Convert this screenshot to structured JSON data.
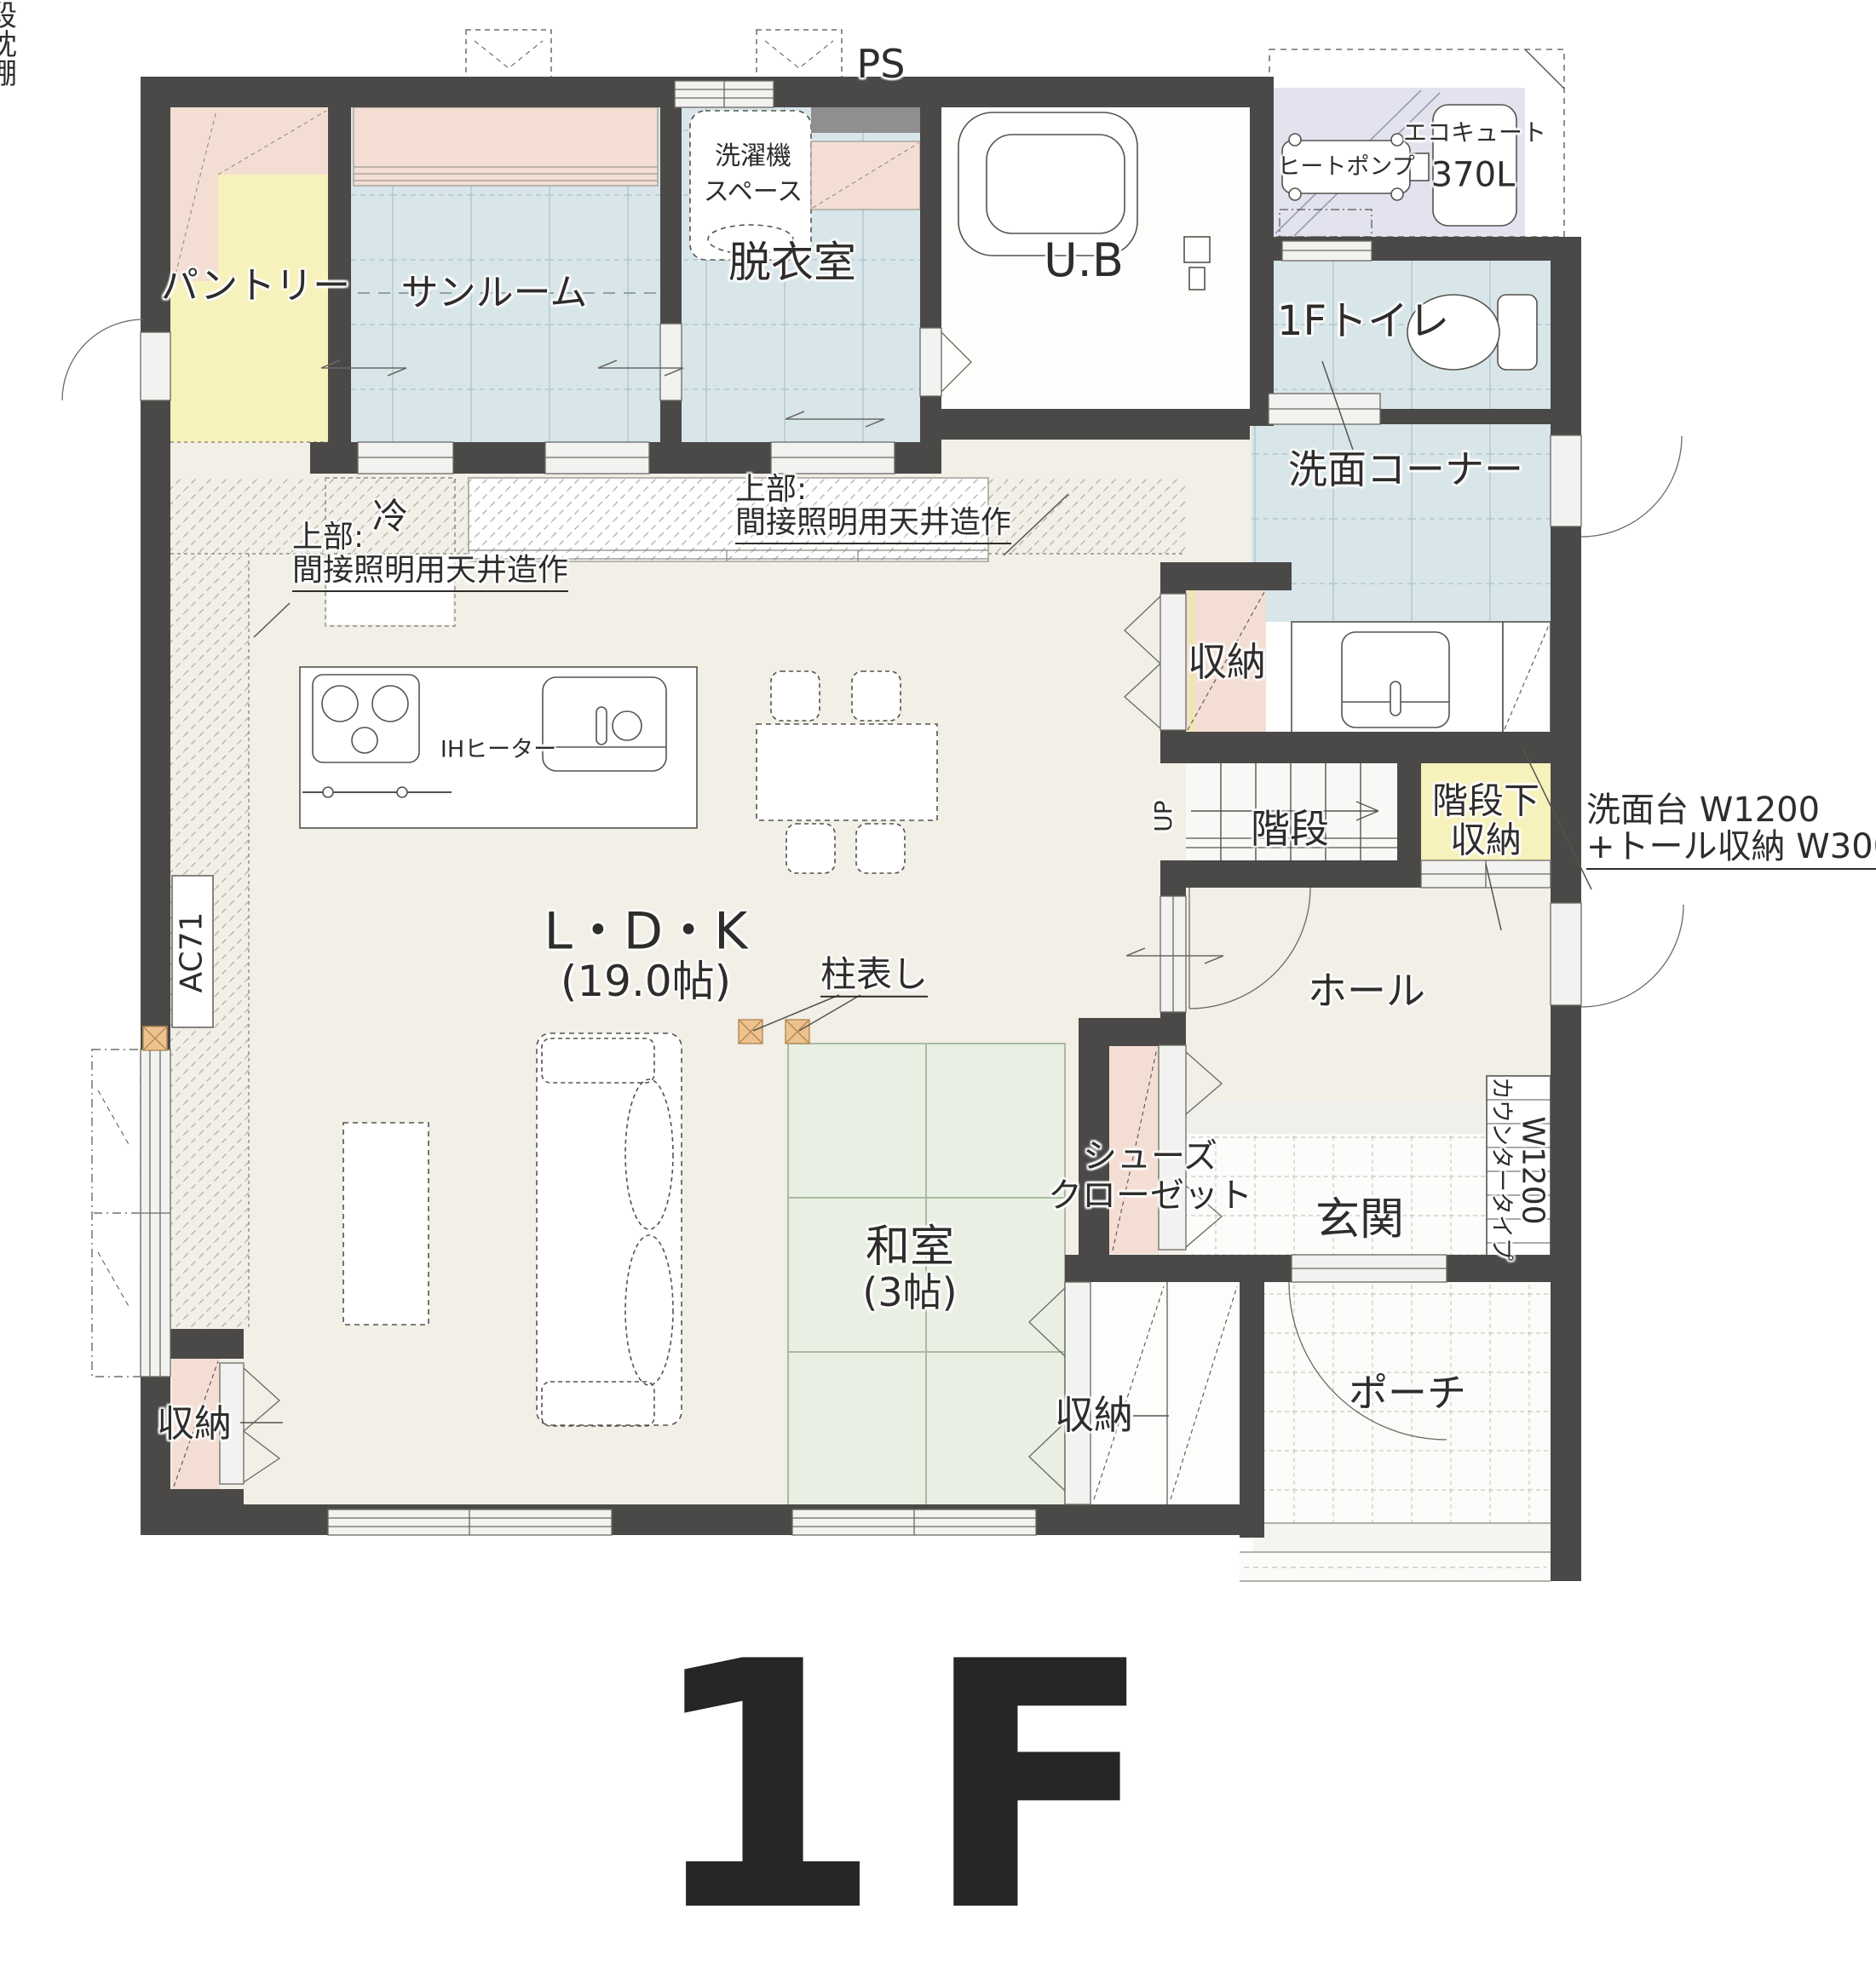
{
  "title": {
    "floor": "1F"
  },
  "colors": {
    "wall": "#4a4947",
    "floor_beige": "#f2efe7",
    "tile_blue": "#d8e6ea",
    "tatami_green": "#e9f0e3",
    "accent_yellow": "#f7f1bb",
    "accent_pink": "#f4ded3",
    "pad_lavender": "#e2e3ef",
    "pillar_orange": "#eec28e",
    "ps_gray": "#8f8f8f"
  },
  "rooms": {
    "pantry": {
      "label": "パントリー"
    },
    "sunroom": {
      "label": "サンルーム"
    },
    "laundry": {
      "line1": "洗濯機",
      "line2": "スペース"
    },
    "ps": {
      "label": "PS"
    },
    "dressing": {
      "label": "脱衣室"
    },
    "bath": {
      "label": "U.B"
    },
    "toilet": {
      "label": "1Fトイレ"
    },
    "wash_corner": {
      "label": "洗面コーナー"
    },
    "storage_wash": {
      "label": "収納"
    },
    "stairs": {
      "label": "階段",
      "up": "UP"
    },
    "under_stairs": {
      "line1": "階段下",
      "line2": "収納"
    },
    "hall": {
      "label": "ホール"
    },
    "entrance": {
      "label": "玄関"
    },
    "shoe_closet": {
      "line1": "シューズ",
      "line2": "クローゼット"
    },
    "ldk": {
      "label": "L・D・K",
      "size": "(19.0帖)"
    },
    "tatami_room": {
      "label": "和室",
      "size": "(3帖)"
    },
    "tatami_closet": {
      "label": "収納",
      "shelf_middle": "中段",
      "shelf_pillow": "枕棚"
    },
    "ldk_storage": {
      "label": "収納"
    },
    "porch": {
      "label": "ポーチ"
    }
  },
  "equipment": {
    "heat_pump": "ヒートポンプ",
    "ecocute_name": "エコキュート",
    "ecocute_capacity": "370L",
    "ih": "IHヒーター",
    "fridge": "冷",
    "ac": "AC71",
    "counter_type": "カウンタータイプ",
    "counter_width": "W1200"
  },
  "annotations": {
    "ceiling_left": {
      "line1": "上部:",
      "line2": "間接照明用天井造作"
    },
    "ceiling_right": {
      "line1": "上部:",
      "line2": "間接照明用天井造作"
    },
    "pillar": "柱表し",
    "vanity": {
      "line1": "洗面台 W1200",
      "line2": "+トール収納 W300"
    }
  }
}
